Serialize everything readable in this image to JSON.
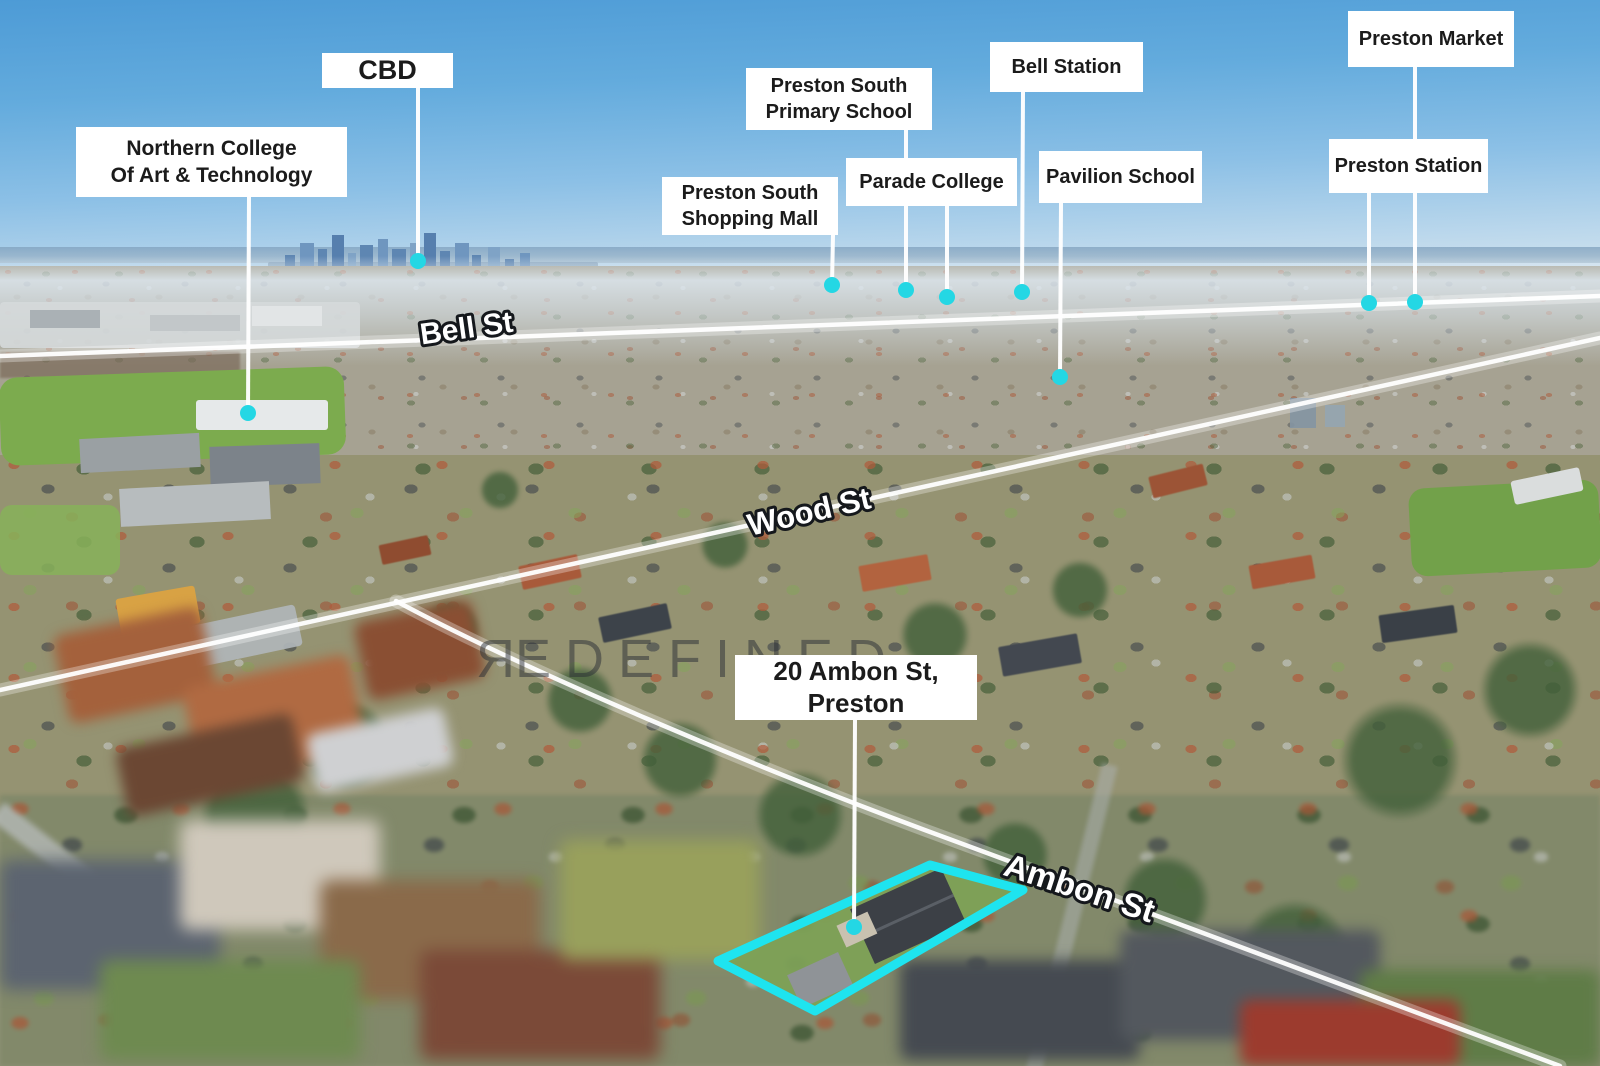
{
  "property": {
    "label_lines": [
      "20 Ambon St,",
      "Preston"
    ]
  },
  "landmarks": [
    {
      "name": "cbd",
      "lines": [
        "CBD"
      ]
    },
    {
      "name": "northern-college",
      "lines": [
        "Northern College",
        "Of Art & Technology"
      ]
    },
    {
      "name": "preston-south-primary-school",
      "lines": [
        "Preston South",
        "Primary School"
      ]
    },
    {
      "name": "preston-south-shopping-mall",
      "lines": [
        "Preston South",
        "Shopping Mall"
      ]
    },
    {
      "name": "parade-college",
      "lines": [
        "Parade College"
      ]
    },
    {
      "name": "bell-station",
      "lines": [
        "Bell Station"
      ]
    },
    {
      "name": "pavilion-school",
      "lines": [
        "Pavilion School"
      ]
    },
    {
      "name": "preston-market",
      "lines": [
        "Preston Market"
      ]
    },
    {
      "name": "preston-station",
      "lines": [
        "Preston Station"
      ]
    }
  ],
  "streets": [
    {
      "name": "Bell St"
    },
    {
      "name": "Wood St"
    },
    {
      "name": "Ambon St"
    }
  ],
  "watermark": {
    "first_letter": "R",
    "rest": "EDEFINED"
  },
  "colors": {
    "marker_dot": "#24d7e4",
    "property_boundary": "#1ee4ef",
    "leader_line": "#ffffff",
    "label_background": "#ffffff",
    "label_text": "#1b1b1b",
    "street_text_fill": "#ffffff",
    "street_text_stroke": "#15181c"
  }
}
